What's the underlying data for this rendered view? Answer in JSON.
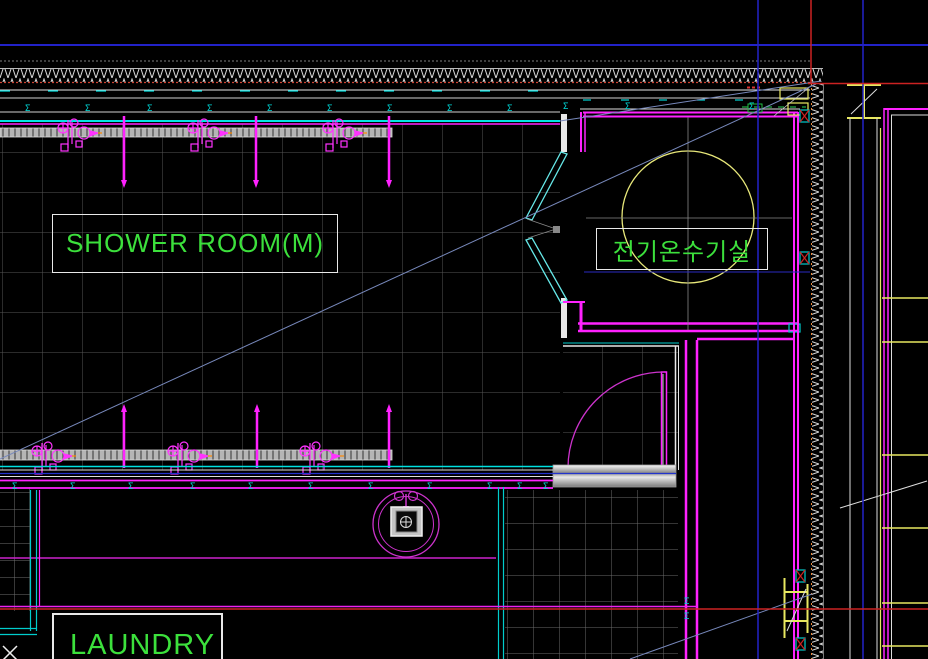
{
  "labels": {
    "shower_room": "SHOWER ROOM(M)",
    "heater_room": "전기온수기실",
    "laundry": "LAUNDRY"
  },
  "symbols": {
    "sigma": "Σ"
  },
  "colors": {
    "background": "#000000",
    "wall_magenta": "#ff22ff",
    "line_cyan": "#00e0e0",
    "label_green": "#3ce03c",
    "heater_circle_yellow": "#e8e87a",
    "grid_gray": "#565656",
    "axis_blue": "#2222c8",
    "axis_red": "#cc2222",
    "steel_yellow": "#e8e860",
    "diagonal_blue_gray": "#7788bb",
    "threshold_gray": "#c0c0c0"
  }
}
